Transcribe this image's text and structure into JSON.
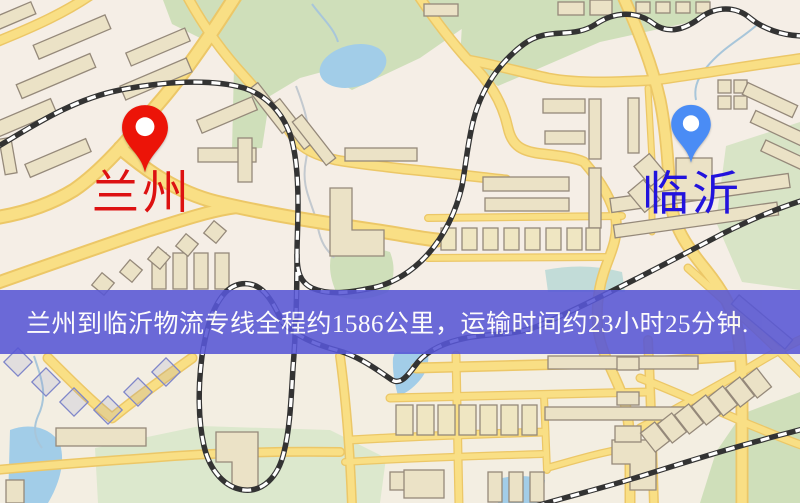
{
  "map": {
    "origin_pin": {
      "label": "兰州",
      "color": "#e9140b"
    },
    "destination_pin": {
      "label": "临沂",
      "color": "#4a8cf5"
    }
  },
  "banner": {
    "text": "兰州到临沂物流专线全程约1586公里，运输时间约23小时25分钟.",
    "origin": "兰州",
    "destination": "临沂",
    "distance_text": "约1586公里",
    "duration_text": "约23小时25分钟"
  },
  "colors": {
    "banner_bg": "#5857d6",
    "banner_text": "#ffffff",
    "origin_label": "#dd1111",
    "destination_label": "#2213dd",
    "origin_pin": "#ec1408",
    "destination_pin": "#4a8cf5",
    "map_background": "#f5eee6",
    "road_fill": "#f9df85",
    "road_casing": "#ecc767",
    "water": "#a2cde8",
    "park_green": "#cfdfba",
    "building_fill": "#ebe2c6",
    "building_stroke": "#95897a",
    "railway": "#333333"
  }
}
